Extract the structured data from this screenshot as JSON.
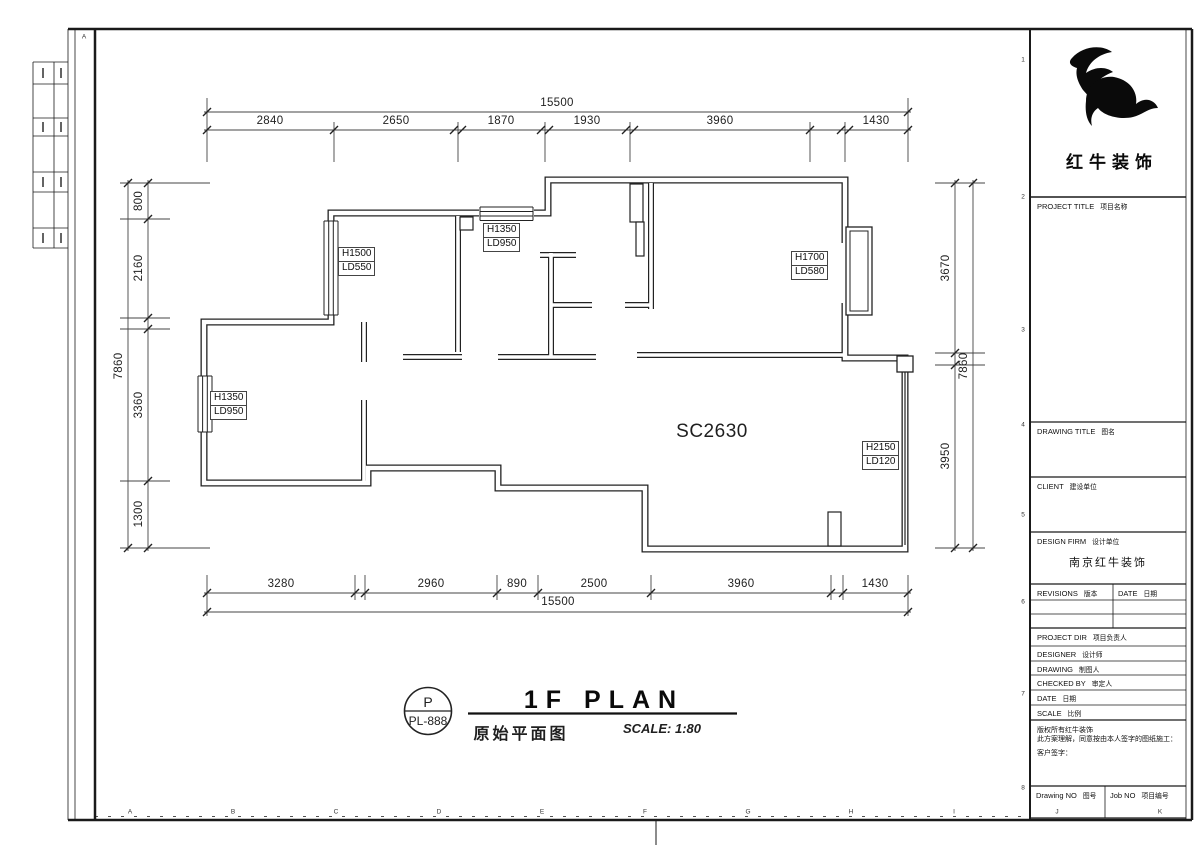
{
  "drawing": {
    "sheet_code": "P",
    "sheet_no": "PL-888",
    "title_en": "1F PLAN",
    "title_cn": "原始平面图",
    "scale_note": "SCALE: 1:80",
    "room_label": "SC2630",
    "window_tags": [
      {
        "l1": "H1500",
        "l2": "LD550"
      },
      {
        "l1": "H1350",
        "l2": "LD950"
      },
      {
        "l1": "H1700",
        "l2": "LD580"
      },
      {
        "l1": "H1350",
        "l2": "LD950"
      },
      {
        "l1": "H2150",
        "l2": "LD120"
      }
    ]
  },
  "dims": {
    "top": {
      "total": "15500",
      "segs": [
        "2840",
        "2650",
        "1870",
        "1930",
        "3960",
        "1430"
      ]
    },
    "bottom": {
      "total": "15500",
      "segs": [
        "3280",
        "2960",
        "890",
        "2500",
        "3960",
        "1430"
      ]
    },
    "left": {
      "total": "7860",
      "segs": [
        "800",
        "2160",
        "3360",
        "1300"
      ]
    },
    "right": {
      "total": "7860",
      "segs": [
        "3670",
        "3950"
      ]
    }
  },
  "titleblock": {
    "brand": "红牛装饰",
    "project_title": {
      "en": "PROJECT TITLE",
      "cn": "项目名称"
    },
    "drawing_title": {
      "en": "DRAWING TITLE",
      "cn": "图名"
    },
    "client": {
      "en": "CLIENT",
      "cn": "建设单位"
    },
    "design_firm": {
      "en": "DESIGN FIRM",
      "cn": "设计单位",
      "value": "南京红牛装饰"
    },
    "revisions": {
      "en": "REVISIONS",
      "cn": "版本"
    },
    "rev_date": {
      "en": "DATE",
      "cn": "日期"
    },
    "project_dir": {
      "en": "PROJECT DIR",
      "cn": "项目负责人"
    },
    "designer": {
      "en": "DESIGNER",
      "cn": "设计师"
    },
    "drawing_by": {
      "en": "DRAWING",
      "cn": "制图人"
    },
    "checked_by": {
      "en": "CHECKED BY",
      "cn": "审定人"
    },
    "date": {
      "en": "DATE",
      "cn": "日期"
    },
    "scale": {
      "en": "SCALE",
      "cn": "比例"
    },
    "notes": [
      "版权所有红牛装饰",
      "此方案理解，同意按由本人签字的图纸施工：",
      "客户签字："
    ],
    "drawing_no": {
      "en": "Drawing NO",
      "cn": "图号"
    },
    "job_no": {
      "en": "Job NO",
      "cn": "项目编号"
    }
  },
  "border": {
    "corner": "A",
    "letters": [
      "A",
      "B",
      "C",
      "D",
      "E",
      "F",
      "G",
      "H",
      "I",
      "J",
      "K"
    ],
    "numbers": [
      "1",
      "2",
      "3",
      "4",
      "5",
      "6",
      "7",
      "8"
    ]
  }
}
